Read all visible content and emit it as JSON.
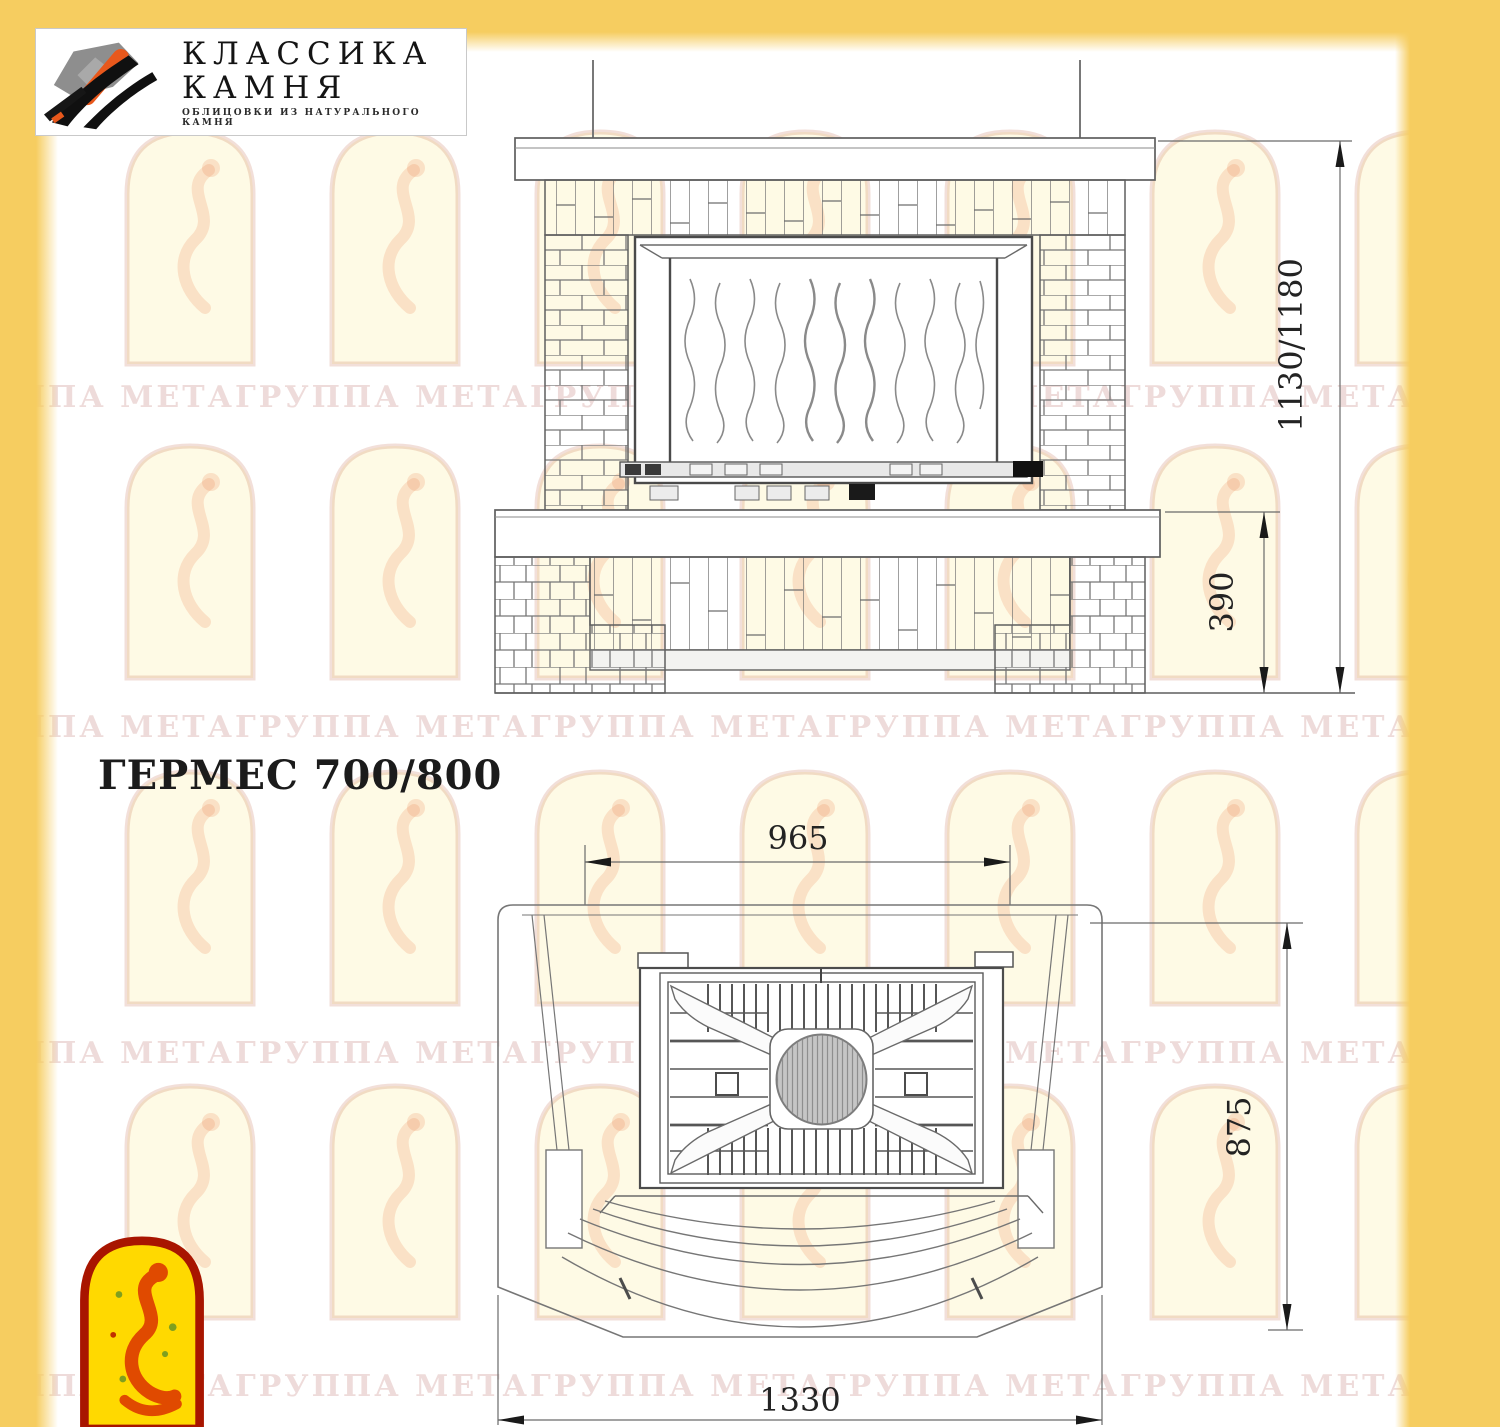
{
  "page": {
    "accent_color": "#F6CD60"
  },
  "header_logo": {
    "line1": "КЛАССИКА",
    "line2": "КАМНЯ",
    "tagline": "ОБЛИЦОВКИ ИЗ НАТУРАЛЬНОГО КАМНЯ"
  },
  "model_title": "ГЕРМЕС 700/800",
  "front_view": {
    "height_dim": "1130/1180",
    "plinth_height_dim": "390"
  },
  "top_view": {
    "firebox_width_dim": "965",
    "depth_dim": "875",
    "overall_width_dim": "1330"
  },
  "watermark_text": "ГРУППА МЕТАГРУППА МЕТАГРУППА МЕТАГРУППА МЕТАГРУППА МЕТА"
}
